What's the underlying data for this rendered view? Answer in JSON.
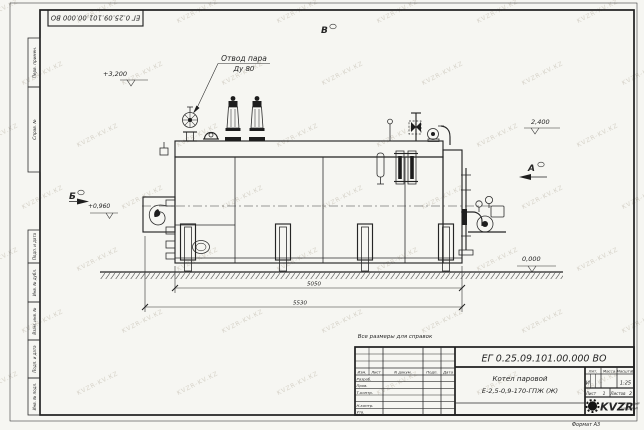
{
  "watermark": {
    "text": "KVZR-KV.KZ"
  },
  "corner_stamp": {
    "doc_number": "ЕГ 0.25.09.101.00.000  ВО"
  },
  "left_stamps": [
    "Перв. примен.",
    "Справ. №",
    "Подп. и дата",
    "Инв. № дубл.",
    "Взам. инв. №",
    "Подп. и дата",
    "Инв. № подл."
  ],
  "annotations": {
    "steam_label1": "Отвод пара",
    "steam_label2": "Ду 80",
    "elev_top": "+3,200",
    "elev_right": "2,400",
    "elev_mid": "+0,960",
    "elev_ground": "0,000",
    "view_b": "Б",
    "view_v": "В",
    "view_a": "А",
    "dim_body": "5050",
    "dim_overall": "5530",
    "note": "Все размеры для справок"
  },
  "title_block": {
    "doc_number": "ЕГ 0.25.09.101.00.000  ВО",
    "product_name_line1": "Котел паровой",
    "product_name_line2": "Е-2,5-0,9-170-ГПЖ (Ж)",
    "rev_headers": [
      "Изм.",
      "Лист",
      "N докум.",
      "Подп.",
      "Дата"
    ],
    "role_rows": [
      "Разраб.",
      "Пров.",
      "Т.контр.",
      "Н.контр.",
      "Утв."
    ],
    "lit_label": "Лит.",
    "mass_label": "Масса",
    "scale_label": "Масштаб",
    "lit_value": "И",
    "scale_value": "1:25",
    "sheet_label": "Лист",
    "sheet_value": "1",
    "sheets_label": "Листов",
    "sheets_value": "2",
    "logo_text": "KVZR",
    "company_line1": "КОТЕЛЬНЫЙ",
    "company_line2": "ЗАВОД РЭП",
    "format": "Формат А3"
  }
}
